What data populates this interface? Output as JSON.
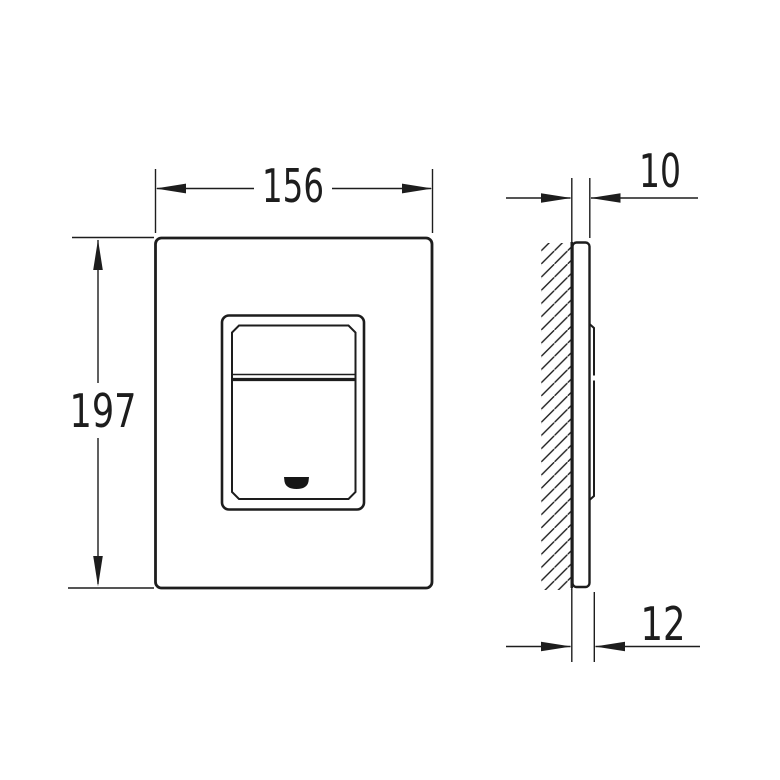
{
  "dimensions": {
    "front_width": "156",
    "front_height": "197",
    "side_top_thickness": "10",
    "side_bottom_thickness": "12"
  },
  "colors": {
    "line": "#1d1d1d",
    "background": "#ffffff"
  }
}
